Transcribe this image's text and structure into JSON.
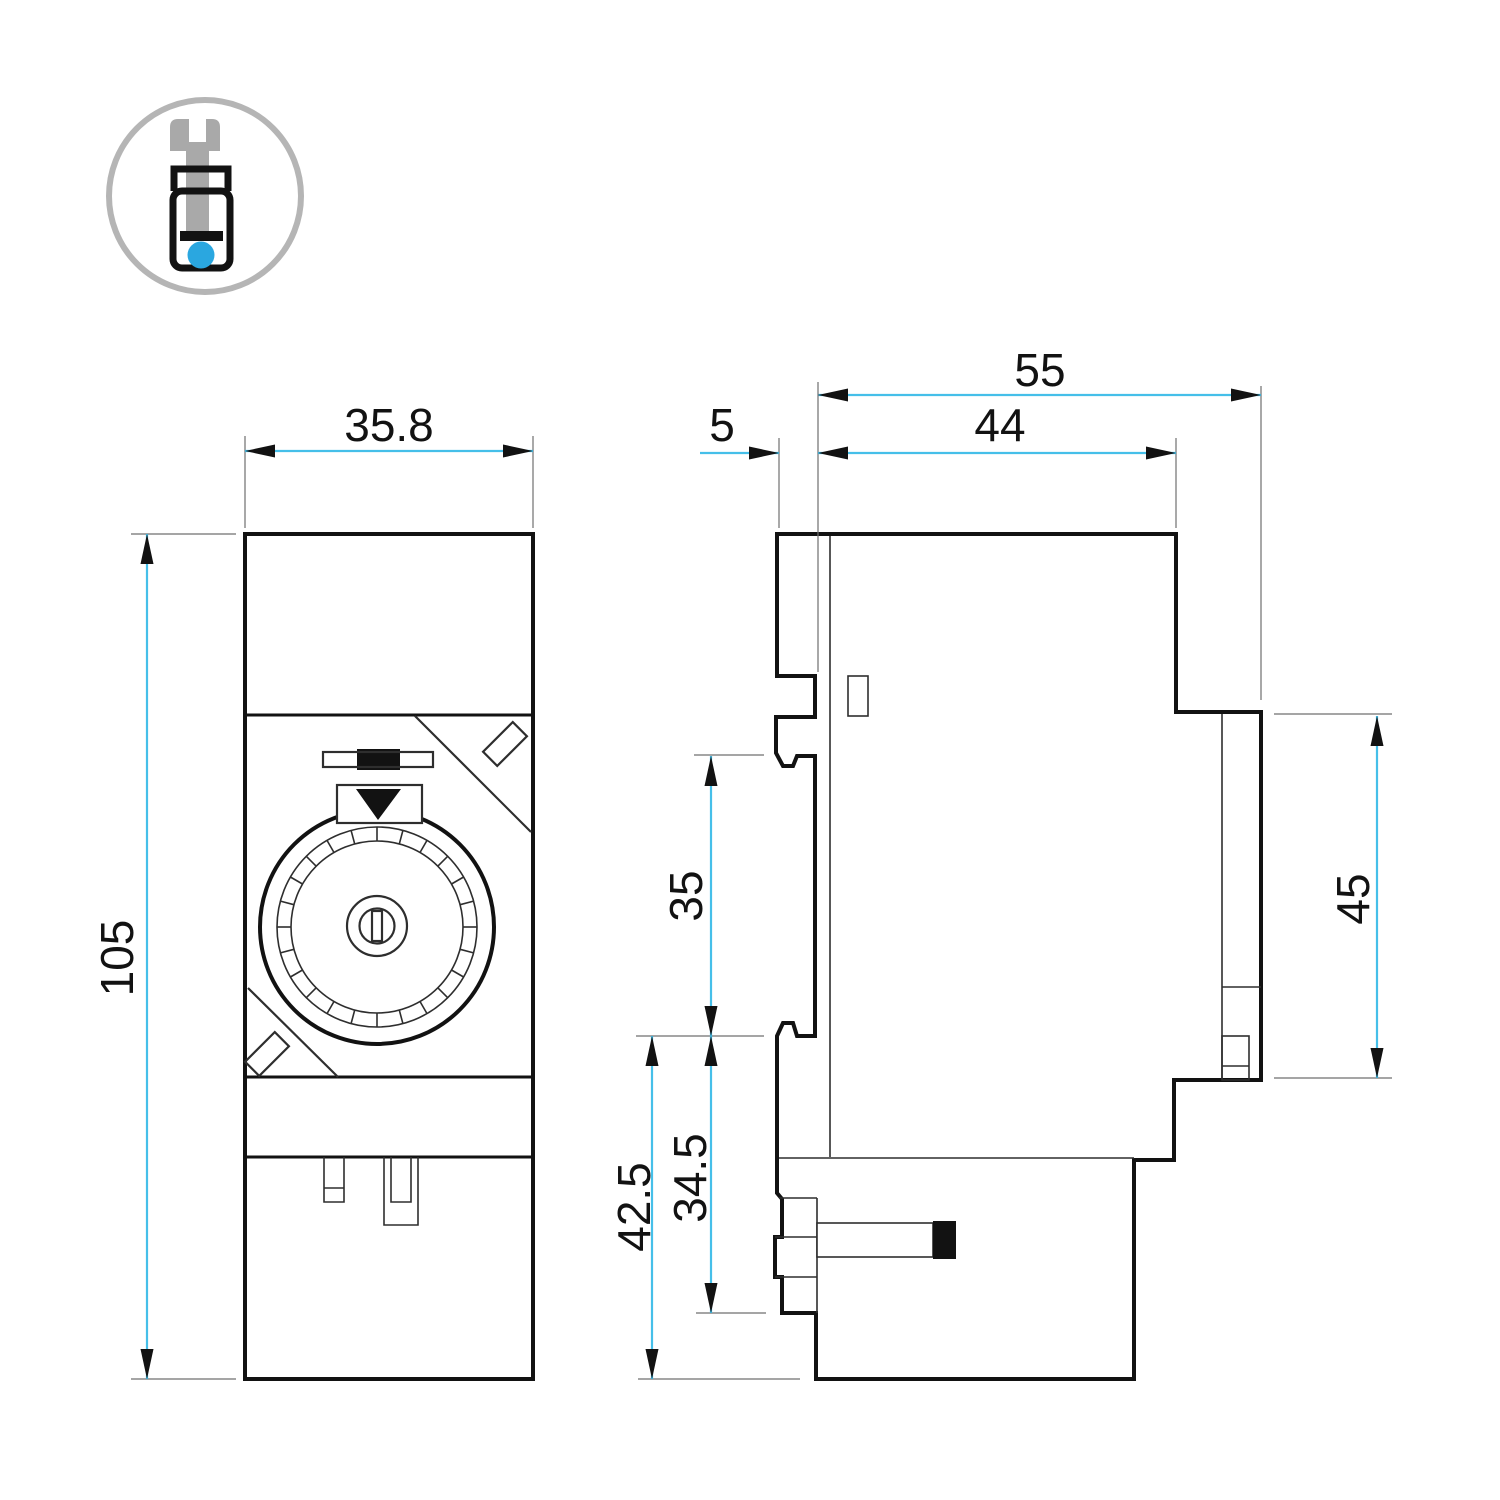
{
  "colors": {
    "background": "#ffffff",
    "outline": "#121212",
    "thin": "#2e2e2e",
    "extension": "#6f6f6f",
    "dimension": "#45bfe9",
    "arrow": "#121212",
    "text": "#121212",
    "icon_gray": "#a9a9a9",
    "icon_ring": "#b5b5b5",
    "icon_blue": "#2aa7e0"
  },
  "icons": {
    "badge": "screw-terminal-icon"
  },
  "drawing": {
    "front_view": {
      "width": "35.8",
      "height": "105"
    },
    "side_view": {
      "total_depth": "55",
      "front_recess": "5",
      "body_depth": "44",
      "din_clip_span": "35",
      "terminal_height": "45",
      "lower_section": "34.5",
      "lower_total": "42.5"
    }
  }
}
